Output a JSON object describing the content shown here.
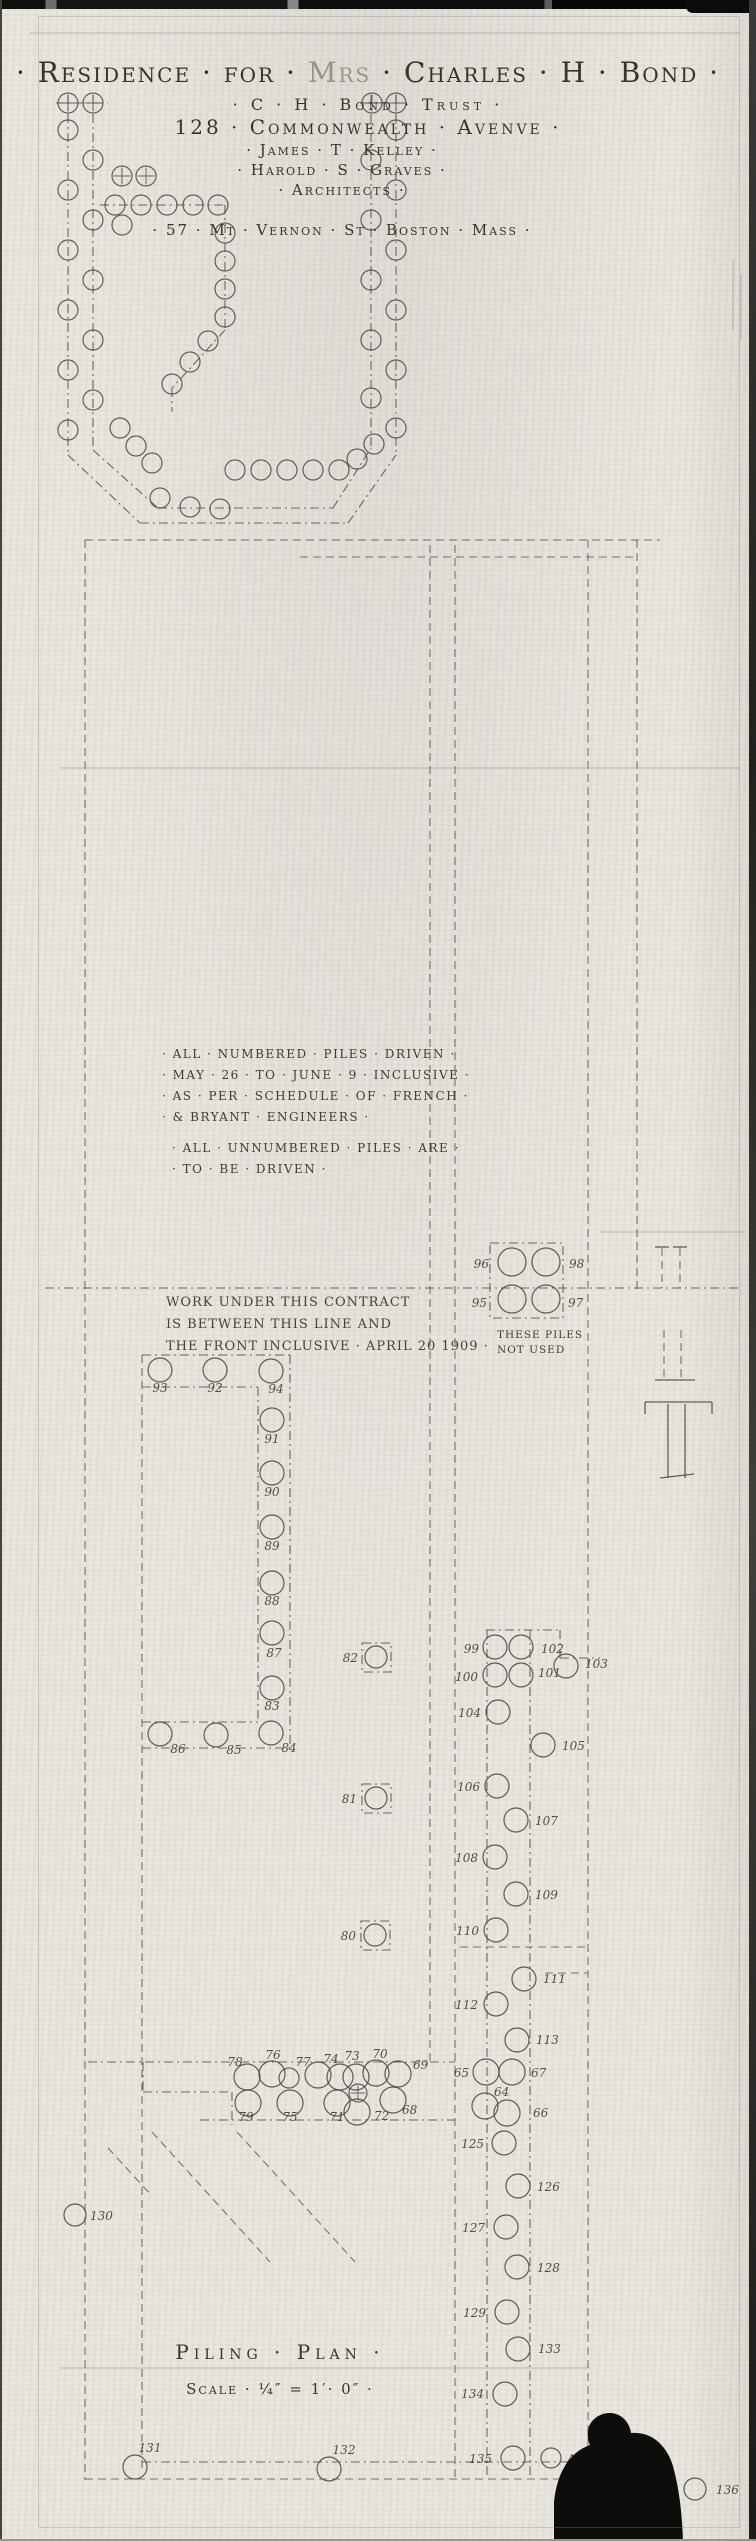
{
  "sheet": {
    "title": {
      "part1": "· Residence · for ·",
      "part2": " Mrs ",
      "part3": "· Charles · H · Bond ·"
    },
    "trust_line": "· C · H · Bond · Trust ·",
    "address_line": "128 · Commonwealth · Avenve ·",
    "architects": {
      "line1": "· James · T · Kelley ·",
      "line2": "· Harold · S · Graves ·",
      "line3": "· Architects ·",
      "line4": "· 57 · Mt · Vernon · St · Boston · Mass ·"
    },
    "notes": {
      "driven": [
        "· ALL · NUMBERED · PILES · DRIVEN ·",
        "· MAY · 26 · TO · JUNE · 9 · INCLUSIVE ·",
        "· AS · PER · SCHEDULE · OF · FRENCH ·",
        "· & BRYANT · ENGINEERS ·"
      ],
      "unnumbered": [
        "· ALL · UNNUMBERED · PILES · ARE ·",
        "· TO · BE · DRIVEN ·"
      ]
    },
    "contract_note": [
      "WORK UNDER THIS CONTRACT",
      "IS BETWEEN THIS LINE AND",
      "THE FRONT INCLUSIVE · APRIL 20 1909 ·"
    ],
    "group_note": [
      "THESE PILES",
      "NOT USED"
    ],
    "plan_title": "Piling · Plan ·",
    "scale_line": "Scale · ¼″ = 1′· 0″ ·"
  },
  "plan": {
    "ink": "#4a4843",
    "pencil": "#45423a",
    "lines": [
      [
        "dd",
        68,
        95,
        68,
        455
      ],
      [
        "dd",
        93,
        95,
        93,
        450
      ],
      [
        "dd",
        396,
        95,
        396,
        455
      ],
      [
        "dd",
        371,
        95,
        371,
        448
      ],
      [
        "dd",
        56,
        103,
        108,
        103
      ],
      [
        "dd",
        360,
        103,
        410,
        103
      ],
      [
        "dd",
        100,
        205,
        225,
        205
      ],
      [
        "dd",
        225,
        205,
        225,
        330
      ],
      [
        "dd",
        225,
        330,
        172,
        388
      ],
      [
        "dd",
        172,
        388,
        172,
        412
      ],
      [
        "dd",
        68,
        455,
        140,
        523
      ],
      [
        "dd",
        140,
        523,
        348,
        523
      ],
      [
        "dd",
        348,
        523,
        396,
        455
      ],
      [
        "dd",
        93,
        450,
        158,
        508
      ],
      [
        "dd",
        158,
        508,
        333,
        508
      ],
      [
        "dd",
        333,
        508,
        371,
        448
      ],
      [
        "d",
        85,
        540,
        660,
        540
      ],
      [
        "d",
        300,
        557,
        637,
        557
      ],
      [
        "d",
        85,
        540,
        85,
        2480
      ],
      [
        "d",
        142,
        1355,
        142,
        2470
      ],
      [
        "d",
        430,
        545,
        430,
        2062
      ],
      [
        "d",
        455,
        545,
        455,
        2477
      ],
      [
        "dd",
        487,
        1630,
        487,
        2477
      ],
      [
        "dd",
        530,
        1630,
        530,
        2477
      ],
      [
        "d",
        588,
        540,
        588,
        2477
      ],
      [
        "d",
        637,
        540,
        637,
        1290
      ],
      [
        "dd",
        45,
        1288,
        742,
        1288
      ],
      [
        "dd",
        142,
        1355,
        290,
        1355
      ],
      [
        "dd",
        290,
        1355,
        290,
        1748
      ],
      [
        "dd",
        142,
        1748,
        290,
        1748
      ],
      [
        "dd",
        142,
        1387,
        258,
        1387
      ],
      [
        "dd",
        258,
        1387,
        258,
        1722
      ],
      [
        "dd",
        142,
        1722,
        258,
        1722
      ],
      [
        "dd",
        486,
        1630,
        560,
        1630
      ],
      [
        "dd",
        560,
        1630,
        560,
        1658
      ],
      [
        "dd",
        560,
        1658,
        600,
        1658
      ],
      [
        "dd",
        88,
        2062,
        455,
        2062
      ],
      [
        "dd",
        143,
        2062,
        143,
        2092
      ],
      [
        "dd",
        143,
        2092,
        232,
        2092
      ],
      [
        "dd",
        232,
        2092,
        232,
        2125
      ],
      [
        "dd",
        200,
        2120,
        455,
        2120
      ],
      [
        "d",
        152,
        2132,
        270,
        2262
      ],
      [
        "d",
        237,
        2132,
        355,
        2262
      ],
      [
        "d",
        108,
        2148,
        152,
        2196
      ],
      [
        "dd",
        142,
        2462,
        588,
        2462
      ],
      [
        "d",
        85,
        2479,
        660,
        2479
      ],
      [
        "d",
        545,
        1973,
        588,
        1973
      ],
      [
        "d",
        460,
        1947,
        588,
        1947
      ],
      [
        "f",
        30,
        33,
        740,
        33
      ],
      [
        "f",
        60,
        768,
        740,
        768
      ],
      [
        "f",
        600,
        1232,
        745,
        1232
      ],
      [
        "f",
        60,
        2368,
        590,
        2368
      ],
      [
        "s",
        655,
        1247,
        669,
        1247
      ],
      [
        "s",
        673,
        1247,
        687,
        1247
      ],
      [
        "d",
        662,
        1248,
        662,
        1288
      ],
      [
        "d",
        680,
        1248,
        680,
        1288
      ],
      [
        "d",
        664,
        1330,
        664,
        1380
      ],
      [
        "d",
        681,
        1330,
        681,
        1380
      ],
      [
        "s",
        655,
        1380,
        695,
        1380
      ],
      [
        "s",
        645,
        1402,
        712,
        1402
      ],
      [
        "s",
        645,
        1402,
        645,
        1414
      ],
      [
        "s",
        712,
        1402,
        712,
        1414
      ],
      [
        "s",
        668,
        1404,
        668,
        1478
      ],
      [
        "s",
        685,
        1404,
        685,
        1478
      ],
      [
        "s",
        660,
        1478,
        694,
        1474
      ],
      [
        "f",
        733,
        260,
        733,
        330
      ],
      [
        "f",
        741,
        275,
        741,
        340
      ]
    ],
    "rects": [
      [
        490,
        1243,
        73,
        75
      ],
      [
        362,
        1643,
        29,
        29
      ],
      [
        362,
        1784,
        29,
        29
      ],
      [
        361,
        1921,
        29,
        29
      ]
    ],
    "circles": [
      [
        68,
        130
      ],
      [
        68,
        190
      ],
      [
        68,
        250
      ],
      [
        68,
        310
      ],
      [
        68,
        370
      ],
      [
        68,
        430
      ],
      [
        93,
        160
      ],
      [
        93,
        220
      ],
      [
        93,
        280
      ],
      [
        93,
        340
      ],
      [
        93,
        400
      ],
      [
        122,
        225
      ],
      [
        396,
        130
      ],
      [
        396,
        190
      ],
      [
        396,
        250
      ],
      [
        396,
        310
      ],
      [
        396,
        370
      ],
      [
        396,
        428
      ],
      [
        371,
        160
      ],
      [
        371,
        220
      ],
      [
        371,
        280
      ],
      [
        371,
        340
      ],
      [
        371,
        398
      ],
      [
        115,
        205
      ],
      [
        141,
        205
      ],
      [
        167,
        205
      ],
      [
        193,
        205
      ],
      [
        218,
        205
      ],
      [
        225,
        233
      ],
      [
        225,
        261
      ],
      [
        225,
        289
      ],
      [
        225,
        317
      ],
      [
        208,
        341
      ],
      [
        190,
        362
      ],
      [
        172,
        384
      ],
      [
        235,
        470
      ],
      [
        261,
        470
      ],
      [
        287,
        470
      ],
      [
        313,
        470
      ],
      [
        339,
        470
      ],
      [
        357,
        459
      ],
      [
        374,
        444
      ],
      [
        120,
        428
      ],
      [
        136,
        446
      ],
      [
        152,
        463
      ],
      [
        160,
        498
      ],
      [
        190,
        507
      ],
      [
        220,
        509
      ],
      [
        289,
        2078
      ]
    ],
    "crossed": [
      [
        68,
        103,
        10
      ],
      [
        93,
        103,
        10
      ],
      [
        372,
        103,
        10
      ],
      [
        396,
        103,
        10
      ],
      [
        122,
        176,
        10
      ],
      [
        146,
        176,
        10
      ],
      [
        358,
        2093,
        9
      ]
    ],
    "piles": [
      {
        "n": "93",
        "x": 160,
        "y": 1370,
        "tx": 160,
        "ty": 1392,
        "a": "m"
      },
      {
        "n": "92",
        "x": 215,
        "y": 1370,
        "tx": 215,
        "ty": 1392,
        "a": "m"
      },
      {
        "n": "94",
        "x": 271,
        "y": 1371,
        "tx": 276,
        "ty": 1393,
        "a": "m"
      },
      {
        "n": "91",
        "x": 272,
        "y": 1420,
        "tx": 272,
        "ty": 1443,
        "a": "m"
      },
      {
        "n": "90",
        "x": 272,
        "y": 1473,
        "tx": 272,
        "ty": 1496,
        "a": "m"
      },
      {
        "n": "89",
        "x": 272,
        "y": 1527,
        "tx": 272,
        "ty": 1550,
        "a": "m"
      },
      {
        "n": "88",
        "x": 272,
        "y": 1583,
        "tx": 272,
        "ty": 1605,
        "a": "m"
      },
      {
        "n": "87",
        "x": 272,
        "y": 1633,
        "tx": 274,
        "ty": 1657,
        "a": "m"
      },
      {
        "n": "83",
        "x": 272,
        "y": 1688,
        "tx": 272,
        "ty": 1710,
        "a": "m"
      },
      {
        "n": "86",
        "x": 160,
        "y": 1734,
        "tx": 178,
        "ty": 1753,
        "a": "m"
      },
      {
        "n": "85",
        "x": 216,
        "y": 1735,
        "tx": 234,
        "ty": 1754,
        "a": "m"
      },
      {
        "n": "84",
        "x": 271,
        "y": 1733,
        "tx": 289,
        "ty": 1752,
        "a": "m"
      },
      {
        "n": "82",
        "x": 376,
        "y": 1657,
        "tx": 358,
        "ty": 1662,
        "a": "e",
        "r": 11
      },
      {
        "n": "81",
        "x": 376,
        "y": 1798,
        "tx": 357,
        "ty": 1803,
        "a": "e",
        "r": 11
      },
      {
        "n": "80",
        "x": 375,
        "y": 1935,
        "tx": 356,
        "ty": 1940,
        "a": "e",
        "r": 11
      },
      {
        "n": "96",
        "x": 512,
        "y": 1262,
        "tx": 489,
        "ty": 1268,
        "a": "e",
        "r": 14
      },
      {
        "n": "98",
        "x": 546,
        "y": 1262,
        "tx": 569,
        "ty": 1268,
        "a": "s",
        "r": 14
      },
      {
        "n": "95",
        "x": 512,
        "y": 1299,
        "tx": 487,
        "ty": 1307,
        "a": "e",
        "r": 14
      },
      {
        "n": "97",
        "x": 546,
        "y": 1299,
        "tx": 568,
        "ty": 1307,
        "a": "s",
        "r": 14
      },
      {
        "n": "99",
        "x": 495,
        "y": 1647,
        "tx": 479,
        "ty": 1653,
        "a": "e"
      },
      {
        "n": "102",
        "x": 521,
        "y": 1647,
        "tx": 541,
        "ty": 1653,
        "a": "s"
      },
      {
        "n": "100",
        "x": 495,
        "y": 1675,
        "tx": 478,
        "ty": 1681,
        "a": "e"
      },
      {
        "n": "101",
        "x": 521,
        "y": 1675,
        "tx": 538,
        "ty": 1677,
        "a": "s"
      },
      {
        "n": "103",
        "x": 566,
        "y": 1666,
        "tx": 585,
        "ty": 1668,
        "a": "s"
      },
      {
        "n": "104",
        "x": 498,
        "y": 1712,
        "tx": 481,
        "ty": 1717,
        "a": "e"
      },
      {
        "n": "105",
        "x": 543,
        "y": 1745,
        "tx": 562,
        "ty": 1750,
        "a": "s"
      },
      {
        "n": "106",
        "x": 497,
        "y": 1786,
        "tx": 480,
        "ty": 1791,
        "a": "e"
      },
      {
        "n": "107",
        "x": 516,
        "y": 1820,
        "tx": 535,
        "ty": 1825,
        "a": "s"
      },
      {
        "n": "108",
        "x": 495,
        "y": 1857,
        "tx": 478,
        "ty": 1862,
        "a": "e"
      },
      {
        "n": "109",
        "x": 516,
        "y": 1894,
        "tx": 535,
        "ty": 1899,
        "a": "s"
      },
      {
        "n": "110",
        "x": 496,
        "y": 1930,
        "tx": 479,
        "ty": 1935,
        "a": "e"
      },
      {
        "n": "111",
        "x": 524,
        "y": 1979,
        "tx": 543,
        "ty": 1983,
        "a": "s"
      },
      {
        "n": "112",
        "x": 496,
        "y": 2004,
        "tx": 478,
        "ty": 2009,
        "a": "e"
      },
      {
        "n": "113",
        "x": 517,
        "y": 2040,
        "tx": 536,
        "ty": 2044,
        "a": "s"
      },
      {
        "n": "65",
        "x": 486,
        "y": 2072,
        "tx": 469,
        "ty": 2077,
        "a": "e",
        "r": 13
      },
      {
        "n": "67",
        "x": 512,
        "y": 2072,
        "tx": 531,
        "ty": 2077,
        "a": "s",
        "r": 13
      },
      {
        "n": "64",
        "x": 485,
        "y": 2106,
        "tx": 494,
        "ty": 2096,
        "a": "s",
        "r": 13
      },
      {
        "n": "66",
        "x": 507,
        "y": 2113,
        "tx": 533,
        "ty": 2117,
        "a": "s",
        "r": 13
      },
      {
        "n": "125",
        "x": 504,
        "y": 2143,
        "tx": 484,
        "ty": 2148,
        "a": "e"
      },
      {
        "n": "126",
        "x": 518,
        "y": 2186,
        "tx": 537,
        "ty": 2191,
        "a": "s"
      },
      {
        "n": "127",
        "x": 506,
        "y": 2227,
        "tx": 485,
        "ty": 2232,
        "a": "e"
      },
      {
        "n": "128",
        "x": 517,
        "y": 2267,
        "tx": 537,
        "ty": 2272,
        "a": "s"
      },
      {
        "n": "129",
        "x": 507,
        "y": 2312,
        "tx": 486,
        "ty": 2317,
        "a": "e"
      },
      {
        "n": "133",
        "x": 518,
        "y": 2349,
        "tx": 538,
        "ty": 2353,
        "a": "s"
      },
      {
        "n": "134",
        "x": 505,
        "y": 2394,
        "tx": 484,
        "ty": 2398,
        "a": "e"
      },
      {
        "n": "135",
        "x": 513,
        "y": 2458,
        "tx": 492,
        "ty": 2463,
        "a": "e"
      },
      {
        "n": "A",
        "x": 551,
        "y": 2458,
        "tx": 567,
        "ty": 2463,
        "a": "s",
        "r": 10
      },
      {
        "n": "136",
        "x": 695,
        "y": 2489,
        "tx": 716,
        "ty": 2494,
        "a": "s",
        "r": 11
      },
      {
        "n": "130",
        "x": 75,
        "y": 2215,
        "tx": 90,
        "ty": 2220,
        "a": "s",
        "r": 11
      },
      {
        "n": "131",
        "x": 135,
        "y": 2467,
        "tx": 150,
        "ty": 2452,
        "a": "m"
      },
      {
        "n": "132",
        "x": 329,
        "y": 2469,
        "tx": 344,
        "ty": 2454,
        "a": "m"
      },
      {
        "n": "78",
        "x": 247,
        "y": 2077,
        "tx": 235,
        "ty": 2066,
        "a": "m",
        "r": 13
      },
      {
        "n": "76",
        "x": 272,
        "y": 2074,
        "tx": 273,
        "ty": 2059,
        "a": "m",
        "r": 13
      },
      {
        "n": "77",
        "x": 318,
        "y": 2075,
        "tx": 303,
        "ty": 2066,
        "a": "m",
        "r": 13
      },
      {
        "n": "74",
        "x": 340,
        "y": 2077,
        "tx": 331,
        "ty": 2063,
        "a": "m",
        "r": 13
      },
      {
        "n": "73",
        "x": 356,
        "y": 2077,
        "tx": 352,
        "ty": 2060,
        "a": "m",
        "r": 13
      },
      {
        "n": "70",
        "x": 376,
        "y": 2073,
        "tx": 380,
        "ty": 2058,
        "a": "m",
        "r": 13
      },
      {
        "n": "69",
        "x": 398,
        "y": 2074,
        "tx": 413,
        "ty": 2069,
        "a": "s",
        "r": 13
      },
      {
        "n": "79",
        "x": 248,
        "y": 2103,
        "tx": 246,
        "ty": 2121,
        "a": "m",
        "r": 13
      },
      {
        "n": "75",
        "x": 290,
        "y": 2103,
        "tx": 290,
        "ty": 2121,
        "a": "m",
        "r": 13
      },
      {
        "n": "71",
        "x": 337,
        "y": 2103,
        "tx": 337,
        "ty": 2121,
        "a": "m",
        "r": 13
      },
      {
        "n": "72",
        "x": 357,
        "y": 2112,
        "tx": 374,
        "ty": 2120,
        "a": "s",
        "r": 13
      },
      {
        "n": "68",
        "x": 393,
        "y": 2100,
        "tx": 402,
        "ty": 2114,
        "a": "s",
        "r": 13
      }
    ],
    "blob": "M554,2541 L554,2502 C557,2472 570,2452 590,2445 C584,2431 590,2418 603,2414 C617,2410 629,2419 631,2433 C652,2431 667,2446 673,2466 C680,2492 682,2516 683,2541 Z"
  }
}
